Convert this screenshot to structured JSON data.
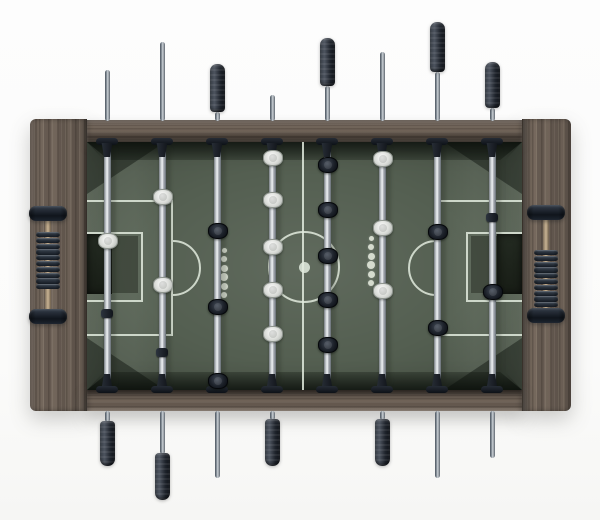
{
  "scene": {
    "subject": "Foosball (table soccer) table photographed from directly above on a white background",
    "teams": {
      "near_side_handles": "white players (rods 1,2,4,6 - grips at bottom)",
      "far_side_handles": "black players (rods 3,5,7,8 - grips at top)"
    },
    "background_color": "#fcfcfc"
  },
  "colors": {
    "wood": "#70645a",
    "wood_dark": "#564c42",
    "wood_light": "#8d8071",
    "field_green": "#545f51",
    "field_bevel_dark": "#2d352c",
    "field_bevel_light": "#76806f",
    "field_line": "rgba(226,235,222,0.85)",
    "goal_recess": "#1c211b",
    "steel_highlight": "#f0f2f4",
    "steel_mid": "#a7b0b7",
    "steel_shadow": "#4e5760",
    "handle_grip": "#1a1f26",
    "white_player": "#eceeea",
    "black_player": "#141921",
    "score_bead": "#1d2631",
    "scorer_stem": "#c9b393"
  },
  "field": {
    "x": 87,
    "y": 142,
    "w": 435,
    "h": 248,
    "center_line_x": 301.5,
    "center_circle": {
      "cx": 304,
      "cy": 267,
      "r": 36,
      "stroke": 2.8
    },
    "center_dot_r": 5.5,
    "line_w": 2.5,
    "left_penalty_box": {
      "x": 87,
      "y": 200,
      "w": 86,
      "h": 136
    },
    "left_goal_box": {
      "x": 87,
      "y": 232,
      "w": 56,
      "h": 70
    },
    "left_arc": {
      "cx": 173,
      "cy": 268,
      "r": 28
    },
    "right_penalty_box": {
      "x": 436,
      "y": 200,
      "w": 86,
      "h": 136
    },
    "right_goal_box": {
      "x": 466,
      "y": 232,
      "w": 56,
      "h": 70
    },
    "right_arc": {
      "cx": 436,
      "cy": 268,
      "r": 28
    },
    "left_goal_dark": {
      "x": 87,
      "y": 234,
      "w": 25,
      "h": 60
    },
    "left_goal_mid": {
      "x": 112,
      "y": 236,
      "w": 26,
      "h": 57
    },
    "right_goal_dark": {
      "x": 497,
      "y": 234,
      "w": 25,
      "h": 60
    },
    "right_goal_mid": {
      "x": 471,
      "y": 236,
      "w": 26,
      "h": 57
    },
    "dot_columns": [
      {
        "x": 224,
        "first_y": 250,
        "step": 9,
        "radii": [
          2.5,
          3,
          3.5,
          4,
          3.5,
          3
        ]
      },
      {
        "x": 371,
        "first_y": 238,
        "step": 9,
        "radii": [
          2.5,
          3,
          3.5,
          4,
          3.5,
          3
        ]
      }
    ]
  },
  "rod_field_span": [
    142,
    390
  ],
  "rods": [
    {
      "n": 1,
      "x": 107,
      "team": "white",
      "role": "goalie",
      "players": [
        240
      ],
      "stoppers": [
        313
      ],
      "top_grip": null,
      "top_rod": [
        70,
        121
      ],
      "bottom_rod": [
        411,
        422
      ],
      "bottom_grip": [
        421,
        466
      ]
    },
    {
      "n": 2,
      "x": 162,
      "team": "white",
      "role": "defense",
      "players": [
        196,
        284
      ],
      "stoppers": [
        352
      ],
      "top_grip": null,
      "top_rod": [
        42,
        121
      ],
      "bottom_rod": [
        411,
        454
      ],
      "bottom_grip": [
        453,
        500
      ]
    },
    {
      "n": 3,
      "x": 217,
      "team": "black",
      "role": "attack",
      "players": [
        230,
        306,
        380
      ],
      "stoppers": [],
      "top_grip": [
        64,
        112
      ],
      "top_rod": [
        112,
        121
      ],
      "bottom_rod": [
        411,
        478
      ],
      "bottom_grip": null
    },
    {
      "n": 4,
      "x": 272,
      "team": "white",
      "role": "midfield",
      "players": [
        157,
        199,
        246,
        289,
        333
      ],
      "stoppers": [],
      "top_grip": null,
      "top_rod": [
        95,
        121
      ],
      "bottom_rod": [
        411,
        420
      ],
      "bottom_grip": [
        419,
        466
      ]
    },
    {
      "n": 5,
      "x": 327,
      "team": "black",
      "role": "midfield",
      "players": [
        164,
        209,
        255,
        299,
        344
      ],
      "stoppers": [],
      "top_grip": [
        38,
        86
      ],
      "top_rod": [
        86,
        121
      ],
      "bottom_rod": null,
      "bottom_grip": null
    },
    {
      "n": 6,
      "x": 382,
      "team": "white",
      "role": "attack",
      "players": [
        158,
        227,
        290
      ],
      "stoppers": [],
      "top_grip": null,
      "top_rod": [
        52,
        121
      ],
      "bottom_rod": [
        411,
        420
      ],
      "bottom_grip": [
        419,
        466
      ]
    },
    {
      "n": 7,
      "x": 437,
      "team": "black",
      "role": "defense",
      "players": [
        231,
        327
      ],
      "stoppers": [],
      "top_grip": [
        22,
        72
      ],
      "top_rod": [
        72,
        121
      ],
      "bottom_rod": [
        411,
        478
      ],
      "bottom_grip": null
    },
    {
      "n": 8,
      "x": 492,
      "team": "black",
      "role": "goalie",
      "players": [
        291
      ],
      "stoppers": [
        217
      ],
      "top_grip": [
        62,
        108
      ],
      "top_rod": [
        108,
        121
      ],
      "bottom_rod": [
        411,
        458
      ],
      "bottom_grip": null
    }
  ],
  "scorers": [
    {
      "side": "left",
      "cx": 48,
      "cap_top_y": 206,
      "cap_bot_y": 309,
      "stem_y": [
        218,
        312
      ],
      "bead_count": 10,
      "beads_from": 232,
      "beads_position": "slid toward top"
    },
    {
      "side": "right",
      "cx": 546,
      "cap_top_y": 205,
      "cap_bot_y": 308,
      "stem_y": [
        217,
        311
      ],
      "bead_count": 10,
      "beads_from": 250,
      "beads_position": "slid toward bottom"
    }
  ],
  "player_size": {
    "w": 18,
    "h": 13.5
  },
  "bushings": {
    "top_y": 138,
    "bottom_y": 374
  }
}
